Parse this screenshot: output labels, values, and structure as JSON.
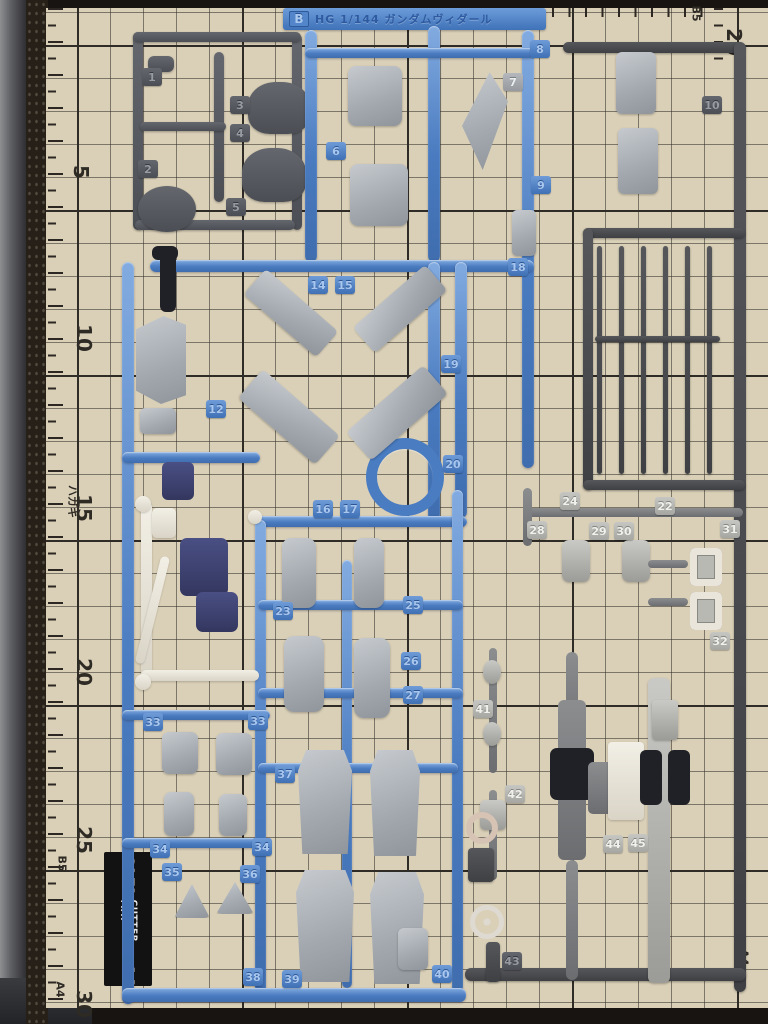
{
  "runner_label": {
    "code": "B",
    "title": "HG 1/144 ガンダムヴィダール"
  },
  "cutting_mat": {
    "brand": "OLFA",
    "product": "CUTTER MAT",
    "size": "A4",
    "scale_labels": [
      {
        "text": "5",
        "x": 74,
        "y": 162,
        "sm": false
      },
      {
        "text": "10",
        "x": 70,
        "y": 328,
        "sm": false
      },
      {
        "text": "15",
        "x": 70,
        "y": 498,
        "sm": false
      },
      {
        "text": "20",
        "x": 70,
        "y": 662,
        "sm": false
      },
      {
        "text": "25",
        "x": 70,
        "y": 830,
        "sm": false
      },
      {
        "text": "30",
        "x": 70,
        "y": 994,
        "sm": false
      },
      {
        "text": "ハガキ",
        "x": 56,
        "y": 496,
        "sm": true
      },
      {
        "text": "B5",
        "x": 54,
        "y": 858,
        "sm": true
      },
      {
        "text": "A4",
        "x": 52,
        "y": 984,
        "sm": true
      },
      {
        "text": "B5",
        "x": 688,
        "y": 8,
        "sm": true
      },
      {
        "text": "20",
        "x": 720,
        "y": 32,
        "sm": false
      },
      {
        "text": "A4",
        "x": 736,
        "y": 952,
        "sm": true
      }
    ]
  },
  "part_tags": [
    {
      "label": "1",
      "x": 142,
      "y": 68,
      "style": "dark"
    },
    {
      "label": "2",
      "x": 138,
      "y": 160,
      "style": "dark"
    },
    {
      "label": "3",
      "x": 230,
      "y": 96,
      "style": "dark"
    },
    {
      "label": "4",
      "x": 230,
      "y": 124,
      "style": "dark"
    },
    {
      "label": "5",
      "x": 226,
      "y": 198,
      "style": "dark"
    },
    {
      "label": "6",
      "x": 326,
      "y": 142,
      "style": "blue"
    },
    {
      "label": "7",
      "x": 503,
      "y": 73,
      "style": "gray"
    },
    {
      "label": "8",
      "x": 530,
      "y": 40,
      "style": "blue"
    },
    {
      "label": "9",
      "x": 531,
      "y": 176,
      "style": "blue"
    },
    {
      "label": "10",
      "x": 702,
      "y": 96,
      "style": "dark"
    },
    {
      "label": "12",
      "x": 206,
      "y": 400,
      "style": "blue"
    },
    {
      "label": "14",
      "x": 308,
      "y": 276,
      "style": "blue"
    },
    {
      "label": "15",
      "x": 335,
      "y": 276,
      "style": "blue"
    },
    {
      "label": "16",
      "x": 313,
      "y": 500,
      "style": "blue"
    },
    {
      "label": "17",
      "x": 340,
      "y": 500,
      "style": "blue"
    },
    {
      "label": "18",
      "x": 508,
      "y": 258,
      "style": "blue"
    },
    {
      "label": "19",
      "x": 441,
      "y": 355,
      "style": "blue"
    },
    {
      "label": "20",
      "x": 443,
      "y": 455,
      "style": "blue"
    },
    {
      "label": "22",
      "x": 655,
      "y": 497,
      "style": "silver"
    },
    {
      "label": "23",
      "x": 273,
      "y": 602,
      "style": "blue"
    },
    {
      "label": "24",
      "x": 560,
      "y": 492,
      "style": "silver"
    },
    {
      "label": "25",
      "x": 403,
      "y": 596,
      "style": "blue"
    },
    {
      "label": "26",
      "x": 401,
      "y": 652,
      "style": "blue"
    },
    {
      "label": "27",
      "x": 403,
      "y": 686,
      "style": "blue"
    },
    {
      "label": "28",
      "x": 527,
      "y": 521,
      "style": "silver"
    },
    {
      "label": "29",
      "x": 589,
      "y": 522,
      "style": "silver"
    },
    {
      "label": "30",
      "x": 614,
      "y": 522,
      "style": "silver"
    },
    {
      "label": "31",
      "x": 720,
      "y": 520,
      "style": "silver"
    },
    {
      "label": "32",
      "x": 710,
      "y": 632,
      "style": "silver"
    },
    {
      "label": "33",
      "x": 143,
      "y": 713,
      "style": "blue"
    },
    {
      "label": "33",
      "x": 248,
      "y": 712,
      "style": "blue"
    },
    {
      "label": "34",
      "x": 150,
      "y": 840,
      "style": "blue"
    },
    {
      "label": "34",
      "x": 252,
      "y": 838,
      "style": "blue"
    },
    {
      "label": "35",
      "x": 162,
      "y": 863,
      "style": "blue"
    },
    {
      "label": "36",
      "x": 240,
      "y": 865,
      "style": "blue"
    },
    {
      "label": "37",
      "x": 275,
      "y": 765,
      "style": "blue"
    },
    {
      "label": "38",
      "x": 243,
      "y": 968,
      "style": "blue"
    },
    {
      "label": "39",
      "x": 282,
      "y": 970,
      "style": "blue"
    },
    {
      "label": "40",
      "x": 432,
      "y": 965,
      "style": "blue"
    },
    {
      "label": "41",
      "x": 473,
      "y": 700,
      "style": "silver"
    },
    {
      "label": "42",
      "x": 505,
      "y": 785,
      "style": "silver"
    },
    {
      "label": "43",
      "x": 502,
      "y": 952,
      "style": "dark"
    },
    {
      "label": "44",
      "x": 603,
      "y": 835,
      "style": "silver"
    },
    {
      "label": "45",
      "x": 628,
      "y": 834,
      "style": "silver"
    }
  ]
}
